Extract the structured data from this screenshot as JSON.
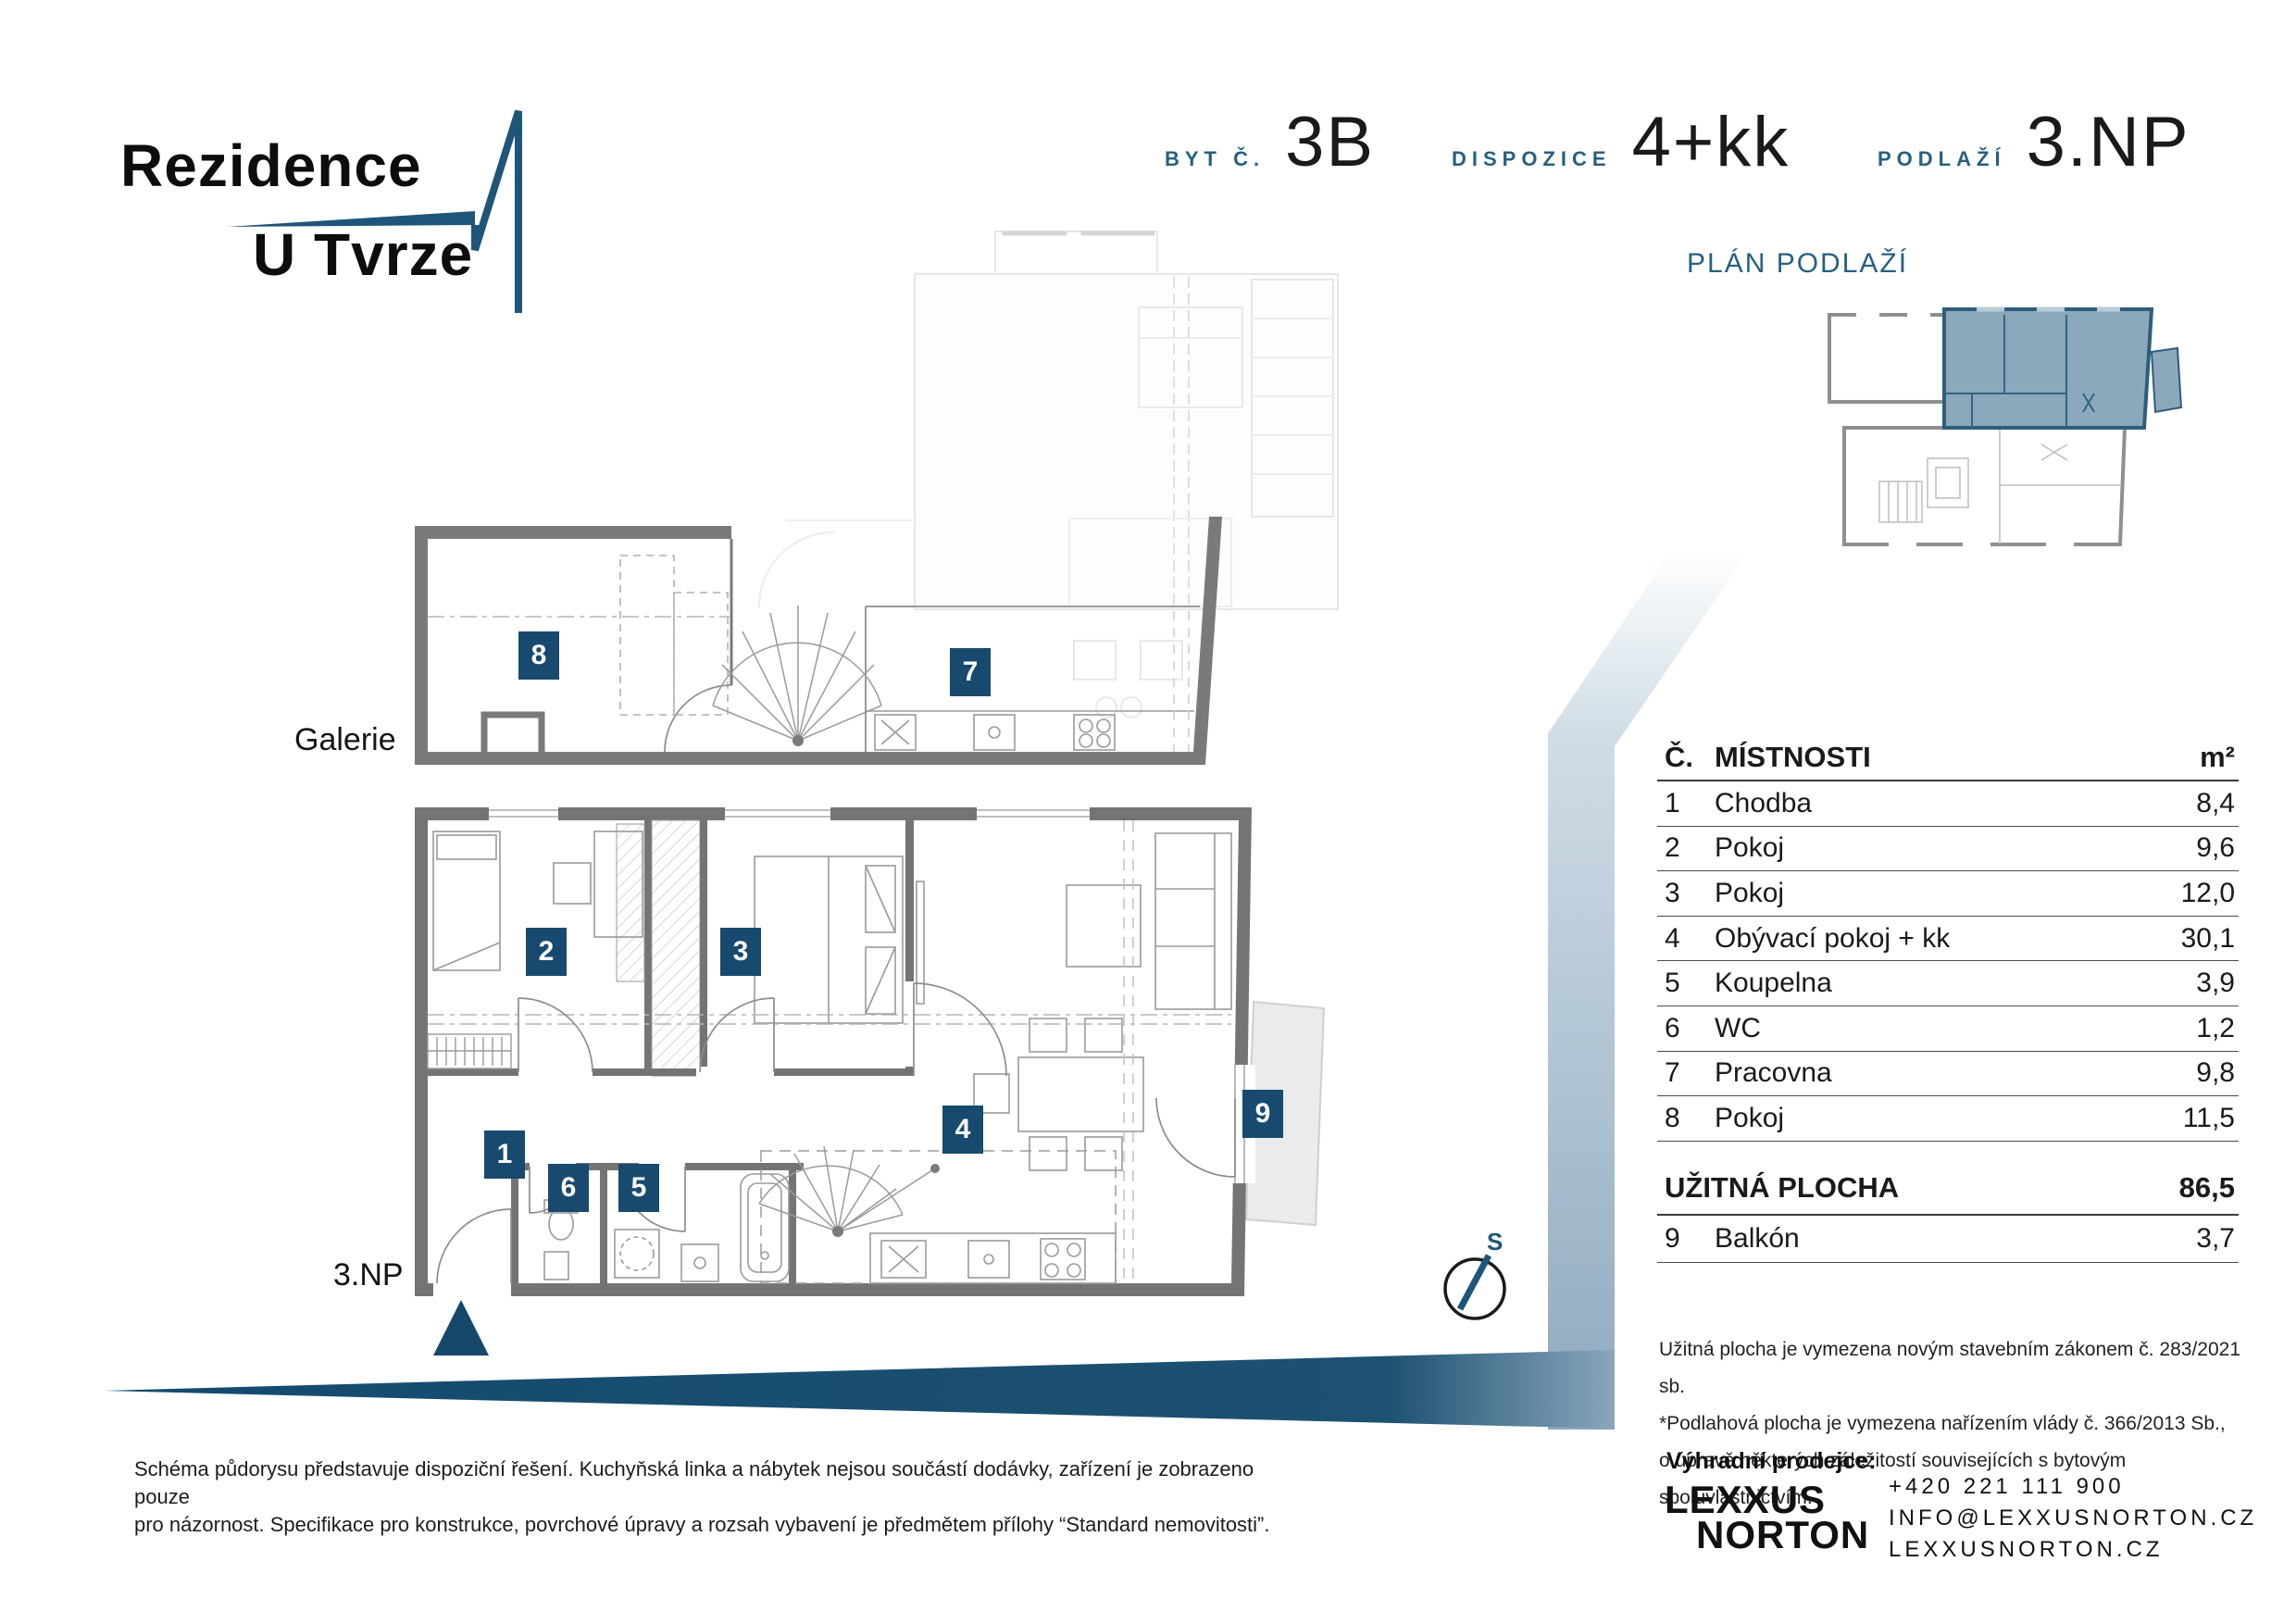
{
  "logo": {
    "line1": "Rezidence",
    "line2": "U Tvrze"
  },
  "header": {
    "unit_label": "BYT Č.",
    "unit_value": "3B",
    "layout_label": "DISPOZICE",
    "layout_value": "4+kk",
    "floor_label": "PODLAŽÍ",
    "floor_value": "3.NP"
  },
  "floor_plan_title": "PLÁN PODLAŽÍ",
  "plan_labels": {
    "gallery": "Galerie",
    "floor": "3.NP",
    "compass": "S"
  },
  "table": {
    "col_number": "Č.",
    "col_name": "MÍSTNOSTI",
    "col_area": "m²",
    "rows": [
      {
        "n": "1",
        "name": "Chodba",
        "area": "8,4"
      },
      {
        "n": "2",
        "name": "Pokoj",
        "area": "9,6"
      },
      {
        "n": "3",
        "name": "Pokoj",
        "area": "12,0"
      },
      {
        "n": "4",
        "name": "Obývací pokoj + kk",
        "area": "30,1"
      },
      {
        "n": "5",
        "name": "Koupelna",
        "area": "3,9"
      },
      {
        "n": "6",
        "name": "WC",
        "area": "1,2"
      },
      {
        "n": "7",
        "name": "Pracovna",
        "area": "9,8"
      },
      {
        "n": "8",
        "name": "Pokoj",
        "area": "11,5"
      }
    ],
    "total_label": "UŽITNÁ PLOCHA",
    "total_value": "86,5",
    "extra_row": {
      "n": "9",
      "name": "Balkón",
      "area": "3,7"
    }
  },
  "footnotes": [
    "Užitná plocha je vymezena novým stavebním zákonem č. 283/2021 sb.",
    "*Podlahová plocha je vymezena nařízením vlády č. 366/2013 Sb.,",
    "o úpravě některých záležitostí souvisejících s bytovým spoluvlastnictvím."
  ],
  "disclaimer": [
    "Schéma půdorysu představuje dispoziční řešení. Kuchyňská linka a nábytek nejsou součástí dodávky, zařízení je zobrazeno pouze",
    "pro názornost. Specifikace pro konstrukce, povrchové úpravy a rozsah vybavení je předmětem přílohy “Standard nemovitosti”."
  ],
  "seller": {
    "label": "Výhradní prodejce:",
    "brand_line1": "LEXXUS",
    "brand_line2": "NORTON",
    "phone": "+420 221 111 900",
    "email": "INFO@LEXXUSNORTON.CZ",
    "web": "LEXXUSNORTON.CZ"
  },
  "colors": {
    "navy": "#174A6E",
    "label_blue": "#27607F",
    "plan_highlight": "#7B9CB3",
    "wall_grey": "#747474",
    "band_blue": "#8EA9BF"
  }
}
